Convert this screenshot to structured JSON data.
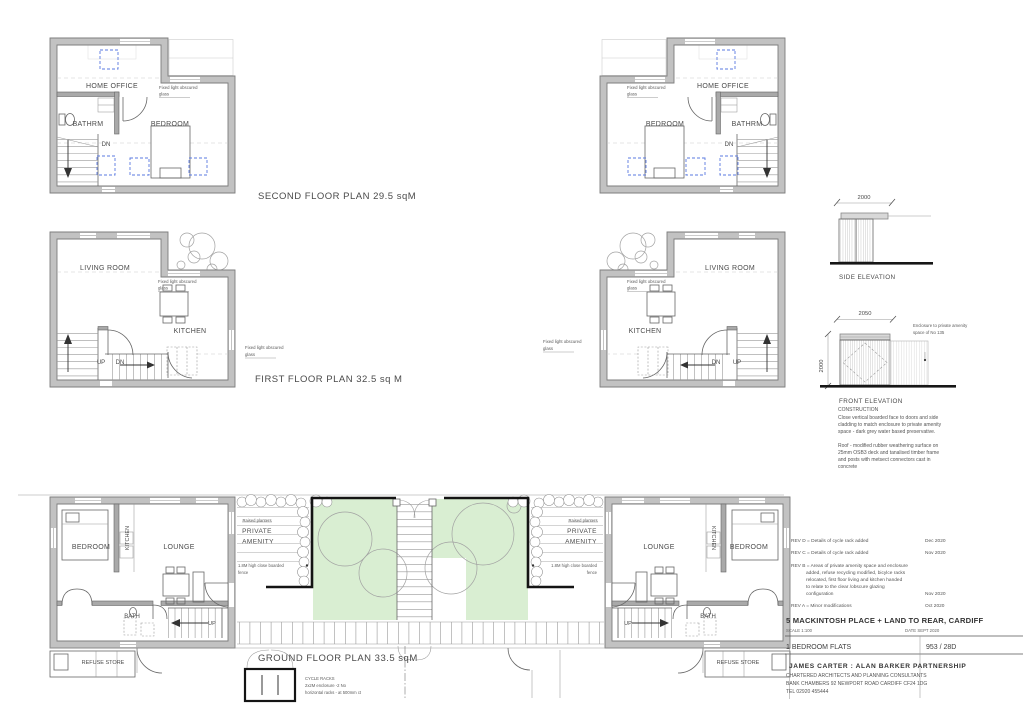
{
  "sheet": {
    "second_floor_title": "SECOND FLOOR PLAN 29.5 sqM",
    "first_floor_title": "FIRST FLOOR PLAN 32.5 sq M",
    "ground_floor_title": "GROUND FLOOR PLAN 33.5 sqM"
  },
  "rooms": {
    "home_office": "HOME OFFICE",
    "bedroom": "BEDROOM",
    "bathrm": "BATHRM",
    "bath": "BATH",
    "living_room": "LIVING ROOM",
    "kitchen": "KITCHEN",
    "lounge": "LOUNGE",
    "dn": "DN",
    "up": "UP",
    "refuse_store": "REFUSE STORE"
  },
  "notes": {
    "fixed_light_1": "Fixed light obscured",
    "fixed_light_2": "glass",
    "raised_planters": "Raised planters",
    "private": "PRIVATE",
    "amenity": "AMENITY",
    "fence_1": "1.8M high close boarded",
    "fence_2": "fence",
    "cycle_1": "CYCLE RACKS",
    "cycle_2": "2x2M enclosure -2 No",
    "cycle_3": "horizontal racks - at 500mm ct"
  },
  "elevations": {
    "side_title": "SIDE ELEVATION",
    "front_title": "FRONT ELEVATION",
    "side_width": "2000",
    "front_width": "2050",
    "front_height": "2000",
    "enclosure_note_1": "Enclosure to private amenity",
    "enclosure_note_2": "space of No 135"
  },
  "construction": {
    "title": "CONSTRUCTION",
    "line1": "Close vertical boarded face to doors and side",
    "line2": "cladding to match enclosure to private amenity",
    "line3": "space - dark grey water based preservative.",
    "line4": "Roof - modified rubber weathering surface on",
    "line5": "25mm OSB3 deck and tanalised timber frame",
    "line6": "and posts  with metsect connectors cast in",
    "line7": "concrete"
  },
  "title_block": {
    "rev_d": "REV D = Details of cycle rack added",
    "rev_d_date": "Dec 2020",
    "rev_c": "REV C = Details of cycle rack added",
    "rev_c_date": "Nov 2020",
    "rev_b_1": "REV B = Areas of private amenity space and enclosure",
    "rev_b_2": "added, refuse recycling modified, bicylce racks",
    "rev_b_3": "relocated, first floor living and kitchen handed",
    "rev_b_4": "to relate to the clear /obscure glazing",
    "rev_b_5": "configuration",
    "rev_b_date": "Nov 2020",
    "rev_a": "REV A = Minor modifications",
    "rev_a_date": "Oct 2020",
    "project": "5 MACKINTOSH PLACE + LAND TO REAR, CARDIFF",
    "scale": "SCALE    1:100",
    "date": "DATE    SEPT 2020",
    "drawing_title": "1 BEDROOM FLATS",
    "drawing_number": "953 /    28D",
    "firm_1": "JAMES CARTER   :   ALAN   BARKER   PARTNERSHIP",
    "firm_2": "CHARTERED ARCHITECTS  AND  PLANNING CONSULTANTS",
    "firm_3": "BANK CHAMBERS 92 NEWPORT ROAD CARDIFF  CF24 1DG",
    "firm_4": "TEL 02920 455444"
  }
}
